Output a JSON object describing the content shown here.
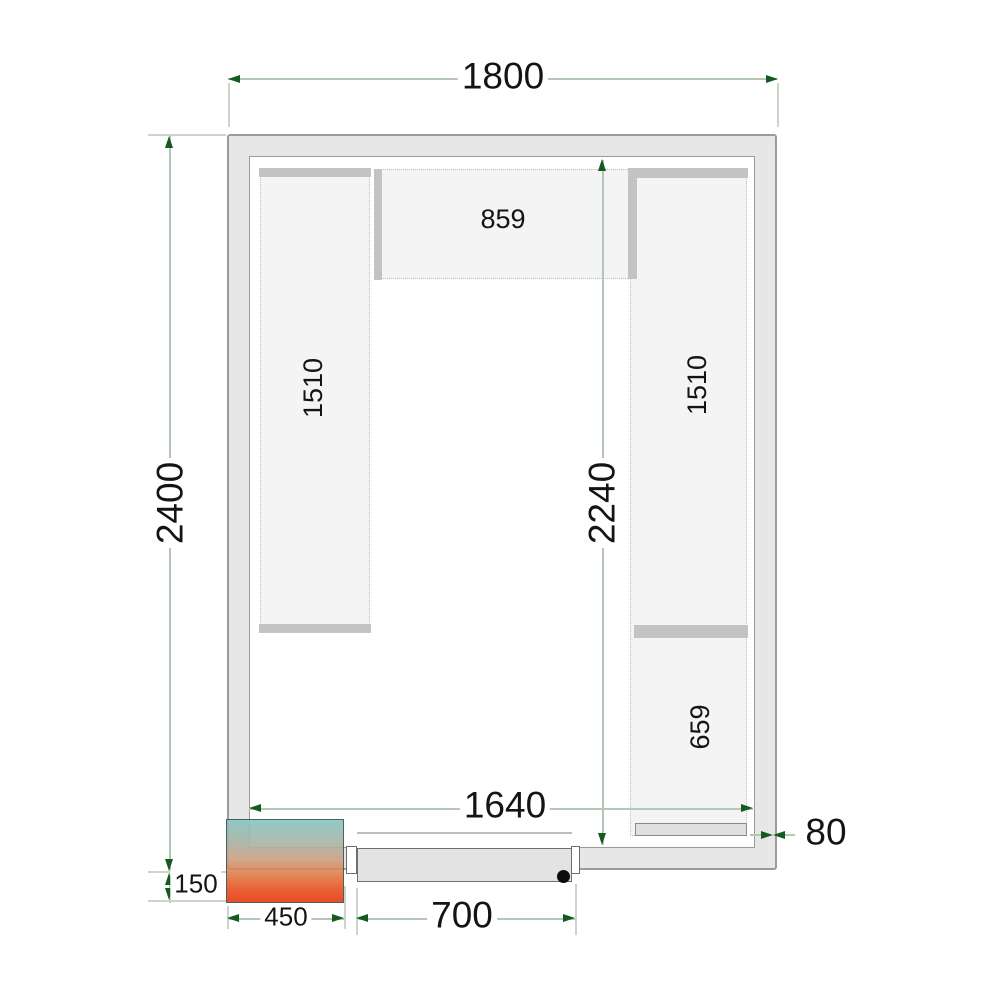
{
  "diagram": {
    "type": "cold-room-floor-plan",
    "labels": {
      "overall_width": "1800",
      "overall_depth": "2400",
      "inner_depth": "2240",
      "inner_width": "1640",
      "top_shelf_length": "859",
      "left_shelf_length": "1510",
      "right_shelf_length": "1510",
      "right_shelf_lower_length": "659",
      "cooling_unit_width": "450",
      "door_width": "700",
      "cooling_unit_offset": "150",
      "wall_thickness": "80"
    },
    "colors": {
      "dimension_line": "#b5c8b5",
      "extension_line": "#c9d6c9",
      "arrow": "#155a1e",
      "wall_fill": "#e7e7e7",
      "wall_border": "#9b9b9b",
      "shelf_fill": "#f4f4f4",
      "shelf_dotted_border": "#bdbdbd",
      "shelf_bar": "#c3c3c3",
      "door_fill": "#e3e3e3",
      "unit_gradient_top": "#86c5c0",
      "unit_gradient_bottom": "#e63c12"
    }
  }
}
